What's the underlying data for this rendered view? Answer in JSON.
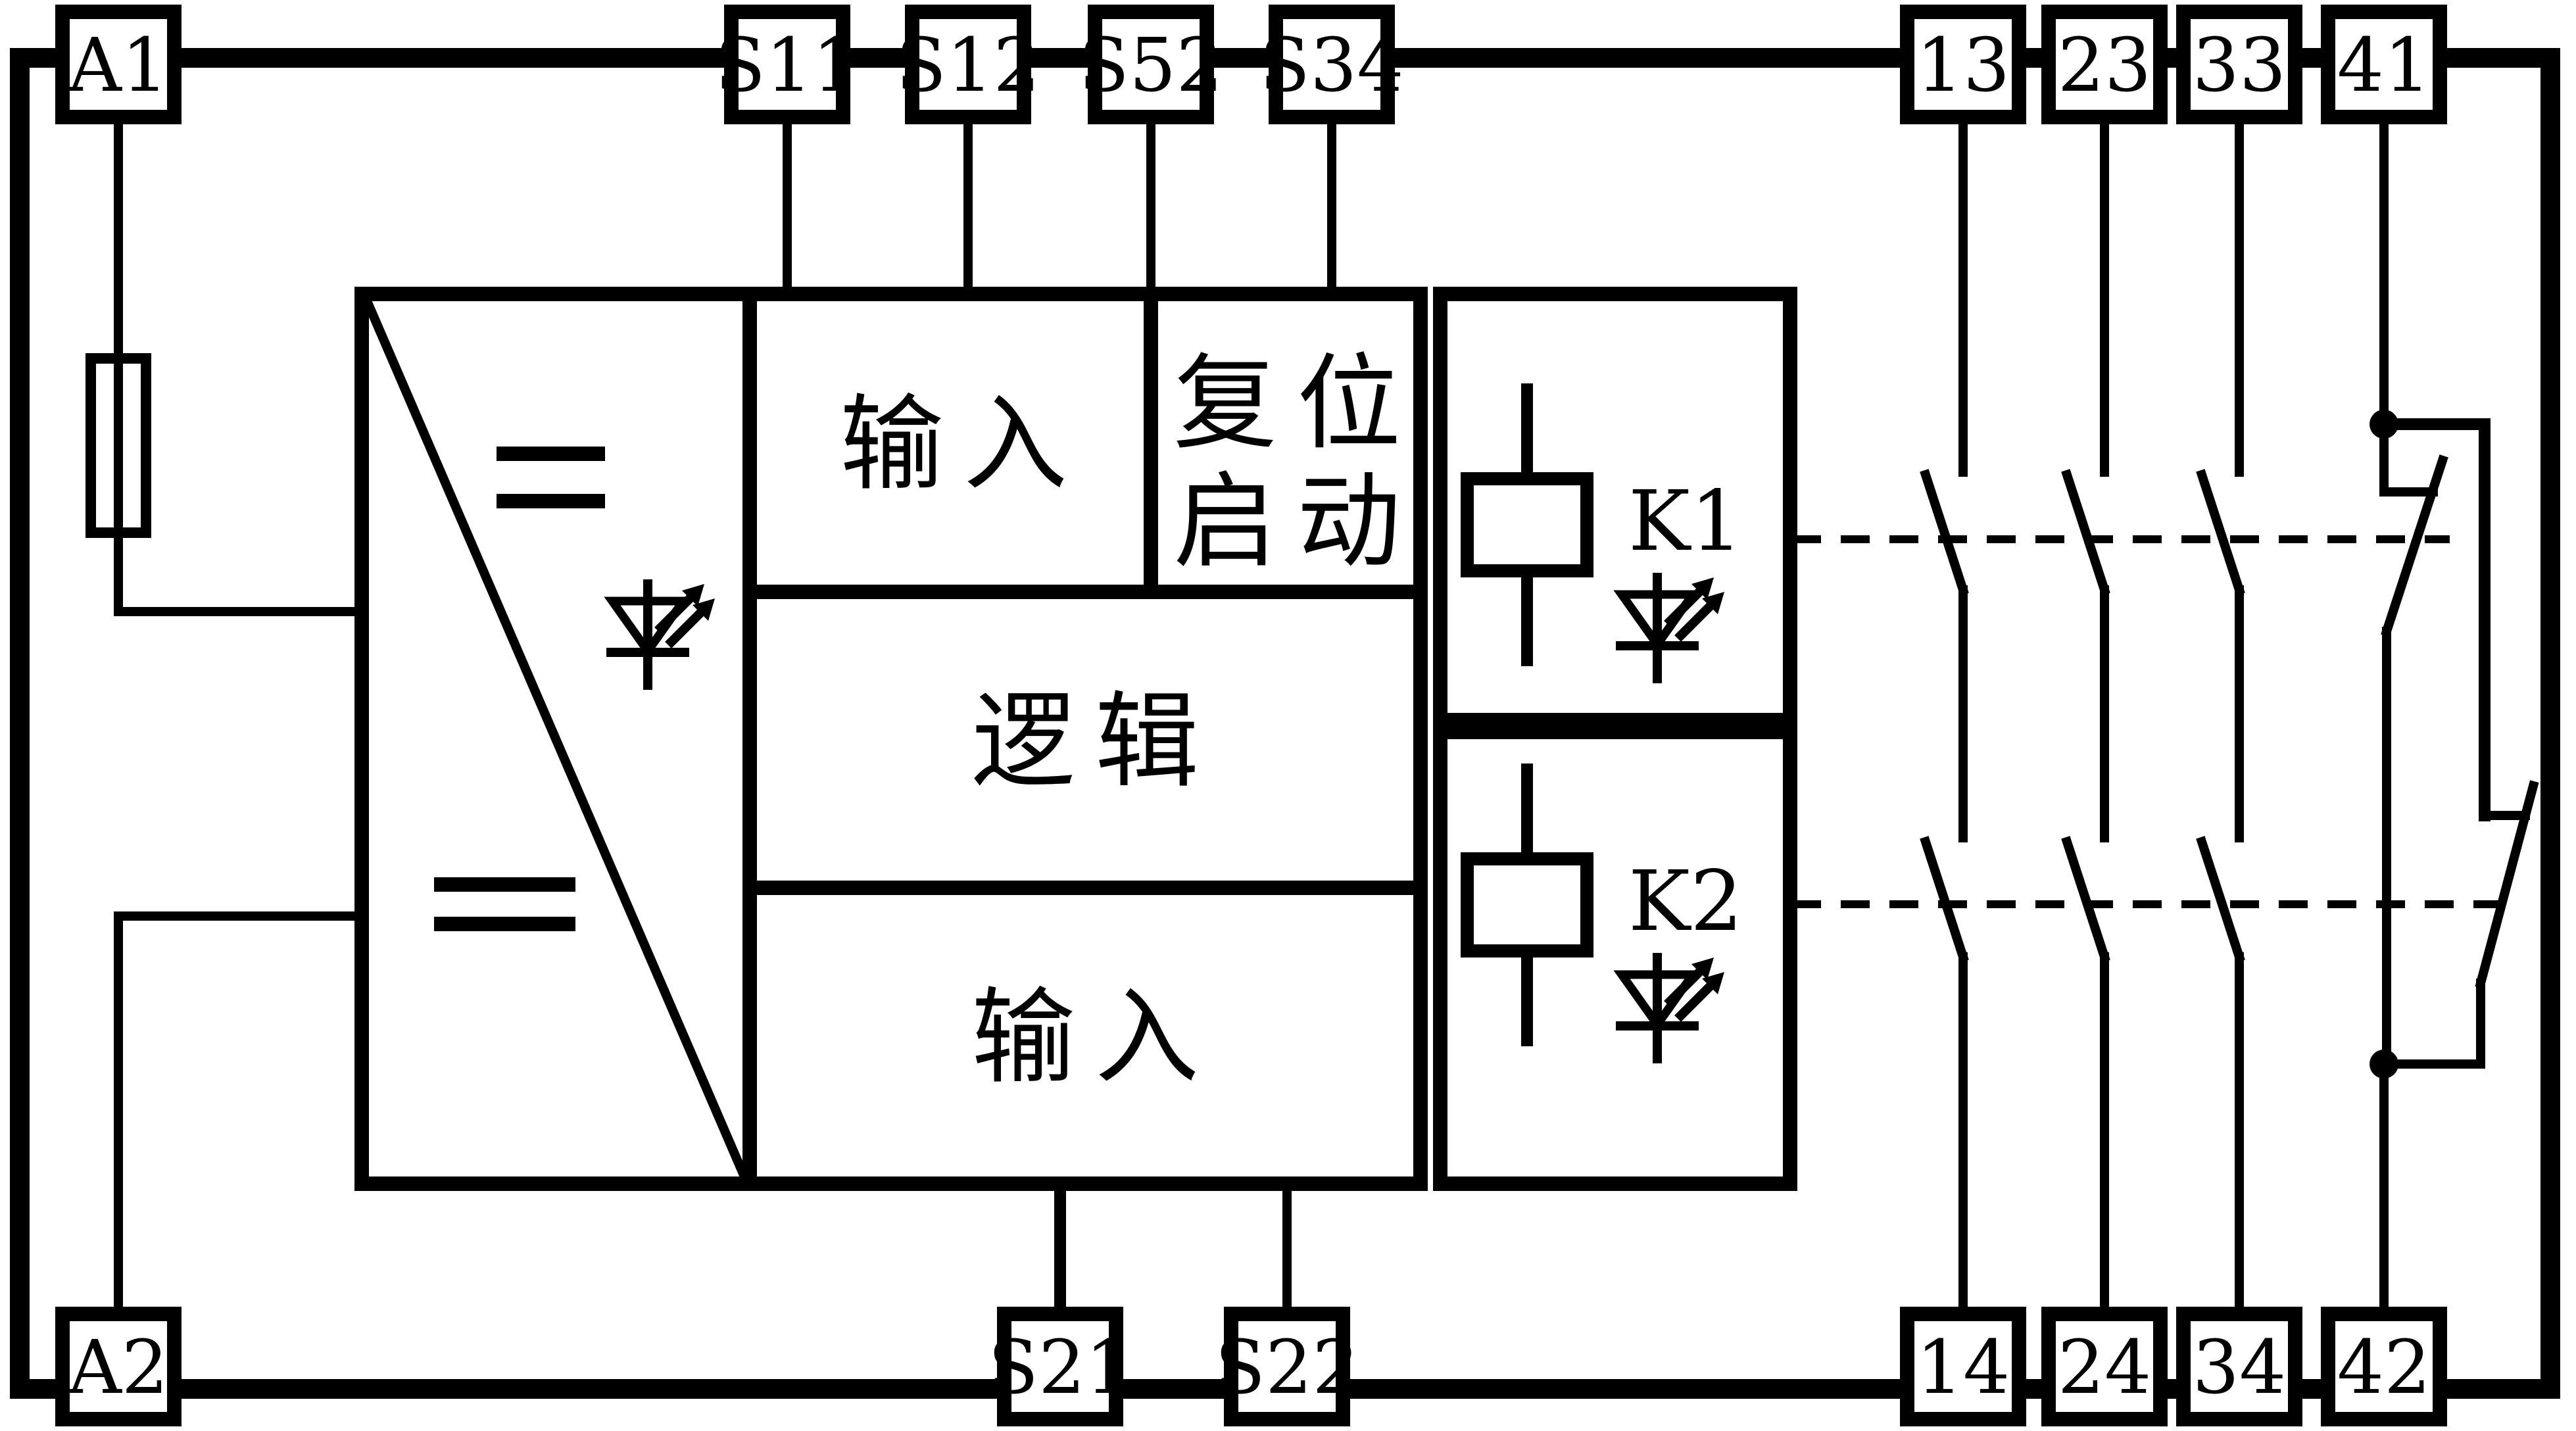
{
  "diagram_title": "Safety relay functional block diagram",
  "colors": {
    "line": "#000000",
    "background": "#ffffff"
  },
  "terminals": {
    "a1": "A1",
    "a2": "A2",
    "s11": "S11",
    "s12": "S12",
    "s52": "S52",
    "s34": "S34",
    "s21": "S21",
    "s22": "S22",
    "n13": "13",
    "n23": "23",
    "n33": "33",
    "n41": "41",
    "n14": "14",
    "n24": "24",
    "n34": "34",
    "n42": "42"
  },
  "blocks": {
    "input_top": "输入",
    "reset_line1": "复位",
    "reset_line2": "启动",
    "logic": "逻辑",
    "input_bottom": "输入",
    "relay1": "K1",
    "relay2": "K2"
  },
  "icons": {
    "fuse": "fuse-icon",
    "dc_supply": "dc-equals-icon",
    "led": "led-indicator-icon",
    "relay_coil": "relay-coil-icon",
    "no_contact": "normally-open-contact",
    "nc_contact": "normally-closed-contact",
    "junction": "junction-dot"
  },
  "contact_columns": [
    {
      "top": "13",
      "bottom": "14",
      "type": "NO"
    },
    {
      "top": "23",
      "bottom": "24",
      "type": "NO"
    },
    {
      "top": "33",
      "bottom": "34",
      "type": "NO"
    },
    {
      "top": "41",
      "bottom": "42",
      "type": "NC"
    }
  ]
}
